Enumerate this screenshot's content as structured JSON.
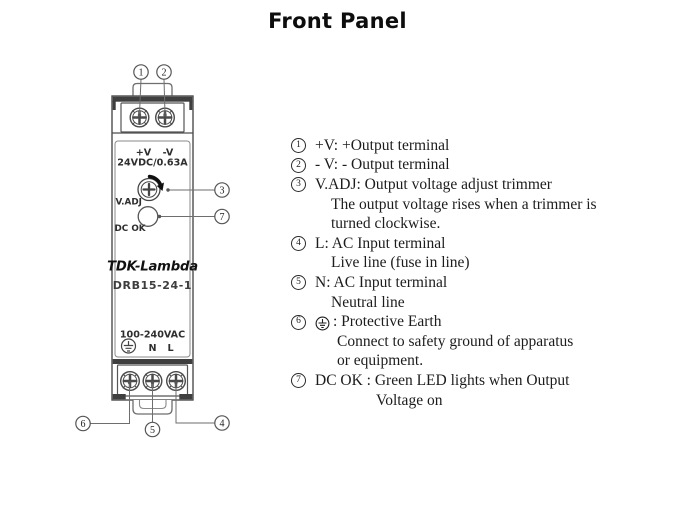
{
  "title": "Front Panel",
  "device": {
    "brand": "TDK-Lambda",
    "model": "DRB15-24-1",
    "output_plus_label": "+V",
    "output_minus_label": "-V",
    "output_rating": "24VDC/0.63A",
    "vadj_label": "V.ADJ",
    "dcok_label": "DC OK",
    "input_rating": "100-240VAC",
    "neutral_label": "N",
    "live_label": "L"
  },
  "callouts": {
    "c1": "1",
    "c2": "2",
    "c3": "3",
    "c4": "4",
    "c5": "5",
    "c6": "6",
    "c7": "7"
  },
  "legend": {
    "rows": [
      {
        "num": "1",
        "text": "+V: +Output terminal"
      },
      {
        "num": "2",
        "text": "- V: - Output terminal"
      },
      {
        "num": "3",
        "text": "V.ADJ: Output voltage adjust trimmer"
      },
      {
        "text": "The output voltage rises when a trimmer is"
      },
      {
        "text": "turned clockwise."
      },
      {
        "num": "4",
        "text": "L: AC Input terminal"
      },
      {
        "text": "Live line (fuse in line)"
      },
      {
        "num": "5",
        "text": "N: AC Input terminal"
      },
      {
        "text": "Neutral line"
      },
      {
        "num": "6",
        "icon": "protective-earth",
        "text": ": Protective Earth"
      },
      {
        "text": "Connect to safety ground of apparatus"
      },
      {
        "text": "or equipment."
      },
      {
        "num": "7",
        "text": "DC OK : Green LED lights when Output"
      },
      {
        "text": "Voltage on"
      }
    ]
  }
}
